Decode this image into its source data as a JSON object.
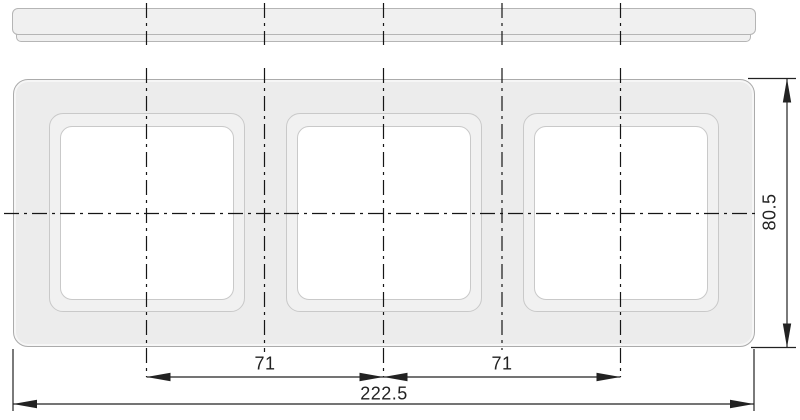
{
  "dimensions": {
    "module_pitch_left": "71",
    "module_pitch_right": "71",
    "overall_width": "222.5",
    "overall_height": "80.5"
  },
  "colors": {
    "background": "#ffffff",
    "frame_fill": "#ececec",
    "bevel_fill": "#f1f1f1",
    "opening_fill": "#ffffff",
    "frame_stroke": "#ababab",
    "bevel_stroke": "#c9c9c9",
    "profile_fill": "#f0f0f0",
    "profile_stroke": "#b5b5b5",
    "centerline_color": "#161616",
    "dimension_color": "#222222"
  }
}
